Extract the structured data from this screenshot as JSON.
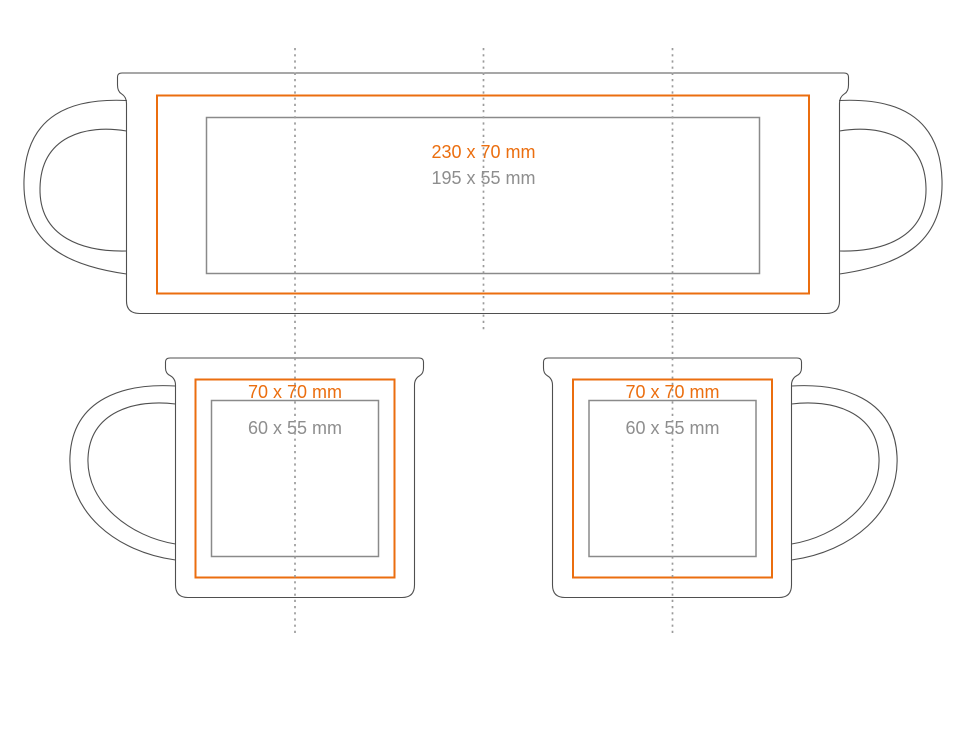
{
  "page": {
    "background": "#ffffff"
  },
  "colors": {
    "page_background": "#ffffff",
    "accent_orange": "#EB6E0F",
    "label_gray": "#8E8E8E",
    "safe_gray": "#8A8A8A",
    "outline_gray": "#4F4F4F",
    "dotted_gray": "#9B9B9B"
  },
  "wrap_mug": {
    "print_area_label": "230 x 70 mm",
    "safe_area_label": "195 x 55 mm"
  },
  "left_mug": {
    "print_area_label": "70 x 70 mm",
    "safe_area_label": "60 x 55 mm"
  },
  "right_mug": {
    "print_area_label": "70 x 70 mm",
    "safe_area_label": "60 x 55 mm"
  }
}
